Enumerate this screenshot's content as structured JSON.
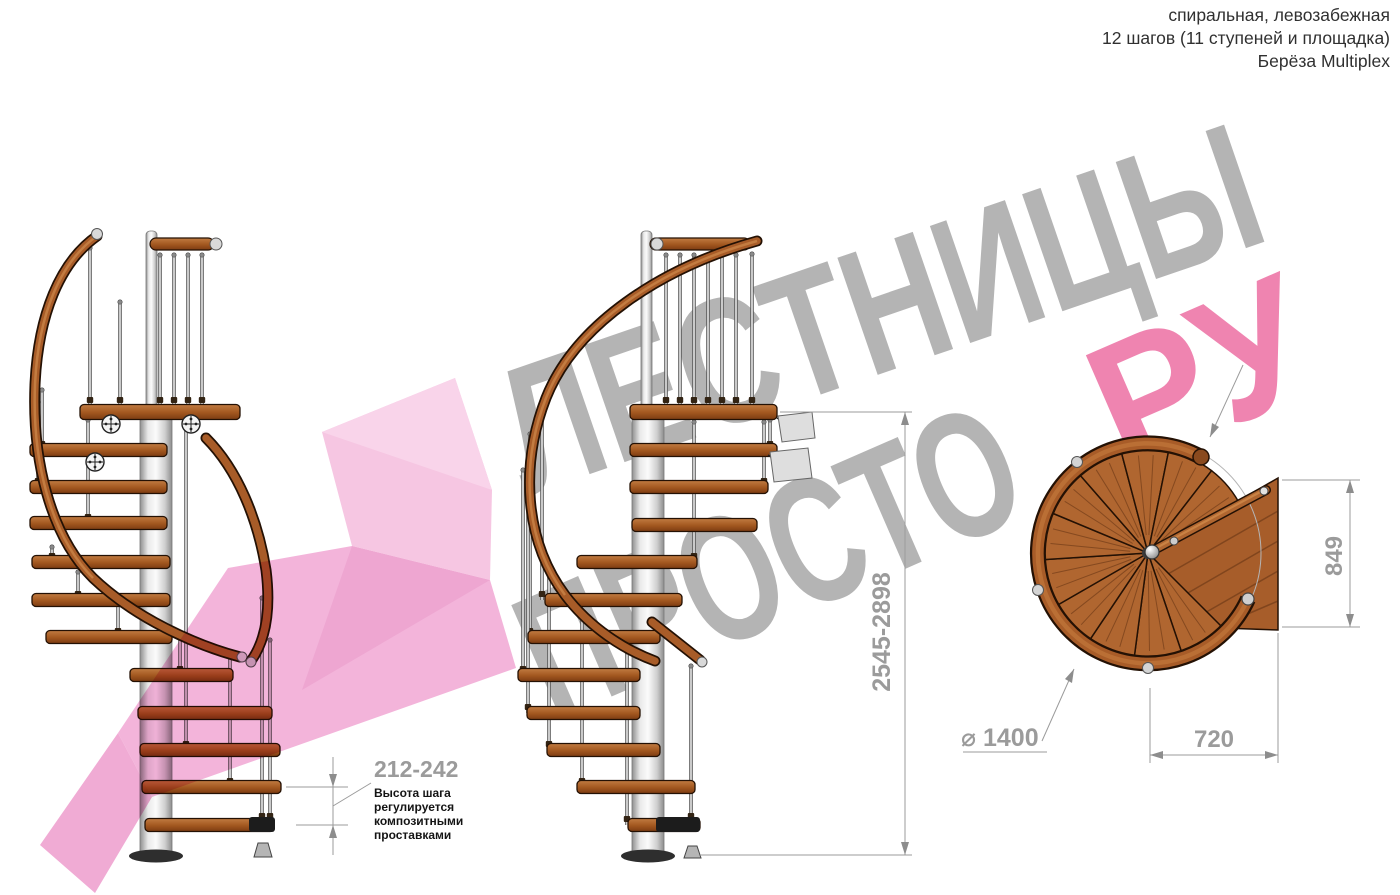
{
  "header": {
    "line1": "спиральная, левозабежная",
    "line2": "12 шагов (11 ступеней и площадка)",
    "line3": "Берёза Multiplex"
  },
  "watermark": {
    "word1": "ЛЕСТНИЦЫ",
    "word2": "ПРОСТО",
    "word2_accent": ".РУ"
  },
  "dimensions": {
    "total_height": "2545-2898",
    "step_height": "212-242",
    "platform_depth": "849",
    "platform_width": "720",
    "diameter": "⌀ 1400"
  },
  "step_note": {
    "line1": "Высота шага",
    "line2": "регулируется",
    "line3": "композитными",
    "line4": "проставками"
  },
  "colors": {
    "watermark_gray": "#b4b4b4",
    "watermark_accent": "#ef84b0",
    "dim_gray": "#9b9b9b",
    "note_black": "#141414",
    "wood": "#a85c28",
    "wood_dark": "#241104",
    "metal": "#d6d6d6",
    "pink_block": "#f6c6e2",
    "pink_block_light": "#f9d4ea",
    "pink_band": "#f3b4da",
    "pink_mid": "#eea6d1",
    "pink_tip": "#f0abd4"
  }
}
